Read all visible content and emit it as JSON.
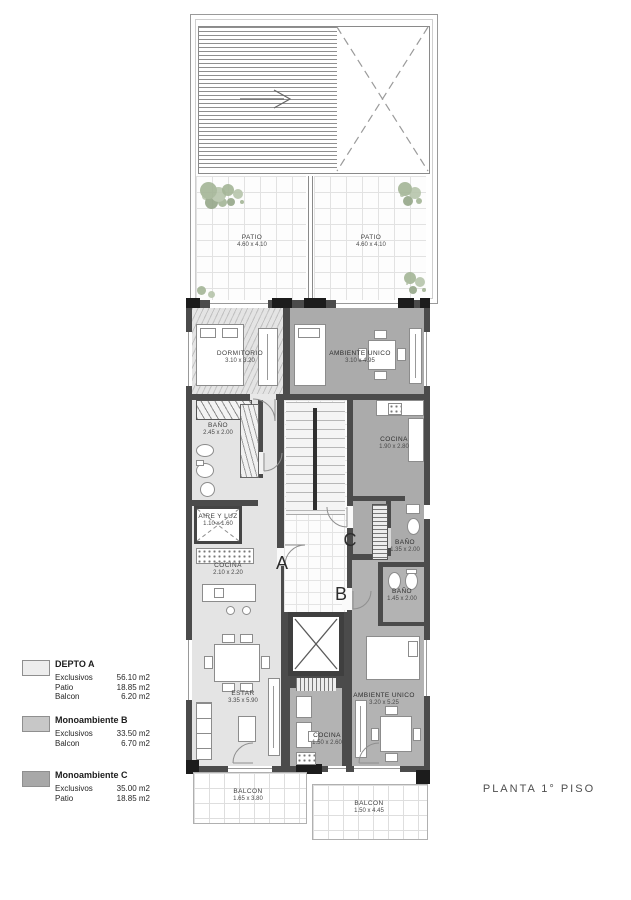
{
  "title": "PLANTA 1° PISO",
  "legend": {
    "units": [
      {
        "name": "DEPTO A",
        "swatch": "#ededed",
        "rows": [
          {
            "label": "Exclusivos",
            "value": "56.10 m2"
          },
          {
            "label": "Patio",
            "value": "18.85 m2"
          },
          {
            "label": "Balcon",
            "value": "6.20 m2"
          }
        ]
      },
      {
        "name": "Monoambiente B",
        "swatch": "#c7c7c7",
        "rows": [
          {
            "label": "Exclusivos",
            "value": "33.50 m2"
          },
          {
            "label": "Balcon",
            "value": "6.70 m2"
          }
        ]
      },
      {
        "name": "Monoambiente C",
        "swatch": "#a8a8a8",
        "rows": [
          {
            "label": "Exclusivos",
            "value": "35.00 m2"
          },
          {
            "label": "Patio",
            "value": "18.85 m2"
          }
        ]
      }
    ]
  },
  "rooms": {
    "patio_left": {
      "label": "PATIO",
      "dim": "4.60 x 4.10"
    },
    "patio_right": {
      "label": "PATIO",
      "dim": "4.60 x 4.10"
    },
    "dormitorio": {
      "label": "DORMITORIO",
      "dim": "3.10 x 3.20"
    },
    "ambiente_unico_c": {
      "label": "AMBIENTE UNICO",
      "dim": "3.10 x 4.95"
    },
    "bano_a": {
      "label": "BAÑO",
      "dim": "2.45 x 2.00"
    },
    "cocina_c": {
      "label": "COCINA",
      "dim": "1.90 x 2.80"
    },
    "aire_y_luz": {
      "label": "AIRE Y LUZ",
      "dim": "1.10 x 1.60"
    },
    "cocina_a": {
      "label": "COCINA",
      "dim": "2.10 x 2.20"
    },
    "bano_c": {
      "label": "BAÑO",
      "dim": "1.35 x 2.00"
    },
    "bano_b": {
      "label": "BAÑO",
      "dim": "1.45 x 2.00"
    },
    "estar": {
      "label": "ESTAR",
      "dim": "3.35 x 5.90"
    },
    "cocina_b": {
      "label": "COCINA",
      "dim": "1.50 x 2.60"
    },
    "ambiente_unico_b": {
      "label": "AMBIENTE UNICO",
      "dim": "3.20 x 5.25"
    },
    "balcon_a": {
      "label": "BALCON",
      "dim": "1.65 x 3.80"
    },
    "balcon_b": {
      "label": "BALCON",
      "dim": "1.50 x 4.45"
    }
  },
  "unit_markers": {
    "a": "A",
    "b": "B",
    "c": "C"
  },
  "colors": {
    "wall": "#4b4b4b",
    "unit_a_floor": "#e4e4e4",
    "unit_b_floor": "#b3b3b3",
    "unit_c_floor": "#ababab",
    "plant_green": "#a4b597"
  }
}
